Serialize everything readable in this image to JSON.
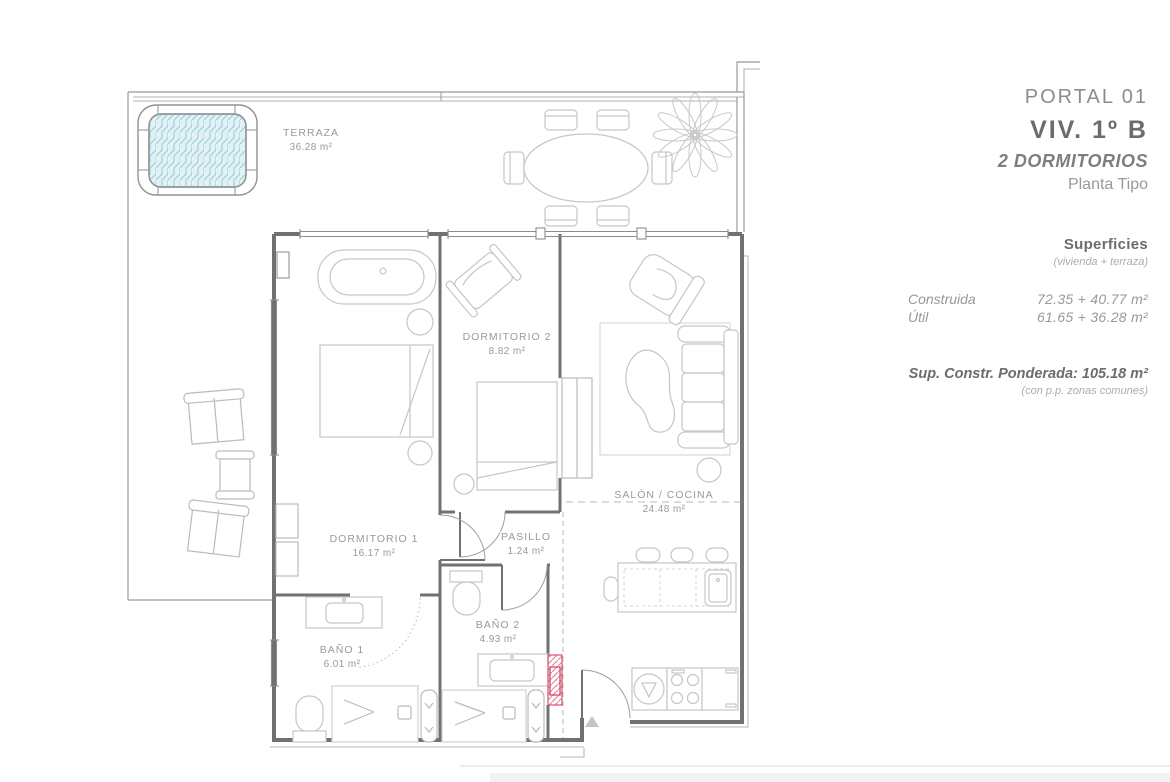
{
  "title_block": {
    "portal": "PORTAL 01",
    "unit": "VIV. 1º B",
    "bedrooms": "2 DORMITORIOS",
    "plan_type": "Planta Tipo"
  },
  "surfaces": {
    "heading": "Superficies",
    "subheading": "(vivienda + terraza)",
    "rows": [
      {
        "label": "Construida",
        "value": "72.35 + 40.77 m²"
      },
      {
        "label": "Útil",
        "value": "61.65 + 36.28 m²"
      }
    ],
    "weighted": "Sup. Constr. Ponderada: 105.18 m²",
    "weighted_note": "(con p.p. zonas comunes)"
  },
  "floor_plan": {
    "rooms": [
      {
        "name": "TERRAZA",
        "area": "36.28 m²"
      },
      {
        "name": "DORMITORIO 2",
        "area": "8.82 m²"
      },
      {
        "name": "SALÓN / COCINA",
        "area": "24.48 m²"
      },
      {
        "name": "DORMITORIO 1",
        "area": "16.17 m²"
      },
      {
        "name": "PASILLO",
        "area": "1.24 m²"
      },
      {
        "name": "BAÑO 1",
        "area": "6.01 m²"
      },
      {
        "name": "BAÑO 2",
        "area": "4.93 m²"
      }
    ],
    "icons": {
      "entrance_arrow": "triangle-up"
    }
  },
  "colors": {
    "wall": "#6f7174",
    "window": "#8a8c8e",
    "terrace_line": "#97999b",
    "furniture_line": "#c5c6c8",
    "label_text": "#97999b",
    "title_text": "#6a6c6f",
    "muted_text": "#aaacae",
    "hot_tub_water": "#e3f1f5",
    "hot_tub_hatch": "#8ecdd6",
    "shaft_accent": "#d9536f"
  }
}
